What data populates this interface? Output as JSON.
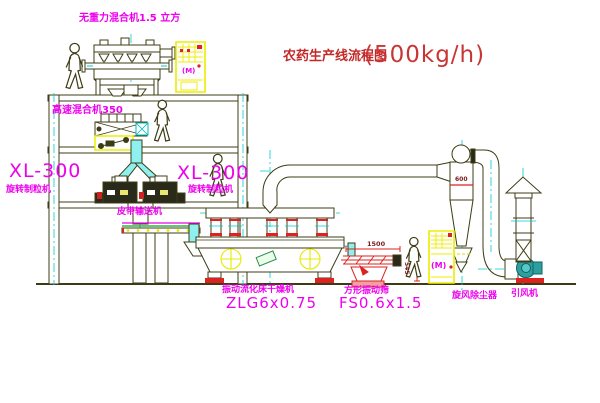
{
  "title": {
    "name": "农药生产线流程图",
    "capacity": "(500kg/h)"
  },
  "equipment_labels": {
    "gravity_mixer": "无重力混合机1.5 立方",
    "high_speed_mixer": "高速混合机350",
    "granulator_left_model": "XL-300",
    "granulator_left_name": "旋转制粒机",
    "granulator_mid_model": "XL-300",
    "granulator_mid_name": "旋转制粒机",
    "belt_conveyor": "皮带输送机",
    "dryer_name": "振动流化床干燥机",
    "dryer_model": "ZLG6x0.75",
    "sieve_name": "方形振动筛",
    "sieve_model": "FS0.6x1.5",
    "cyclone_name": "旋风除尘器",
    "fan_name": "引风机"
  },
  "dimensions": {
    "cyclone_width": "600",
    "sieve_length": "1500",
    "sieve_height": "545"
  },
  "annotations": {
    "motor_mark_cabinet1": "(M)",
    "motor_mark_cabinet2": "(M)"
  },
  "colors": {
    "line": "#3c3c14",
    "cyan": "#00cccc",
    "duct_fill": "#8ff0f0",
    "magenta": "#ee00ee",
    "red": "#dd2222",
    "title_red": "#c22a2a",
    "yellow": "#ededoo-note-yellow",
    "cabinet_yellow": "#eded00",
    "green": "#00aa22",
    "dim_red": "#7a1a1a",
    "fan_teal": "#2f9e9e"
  }
}
